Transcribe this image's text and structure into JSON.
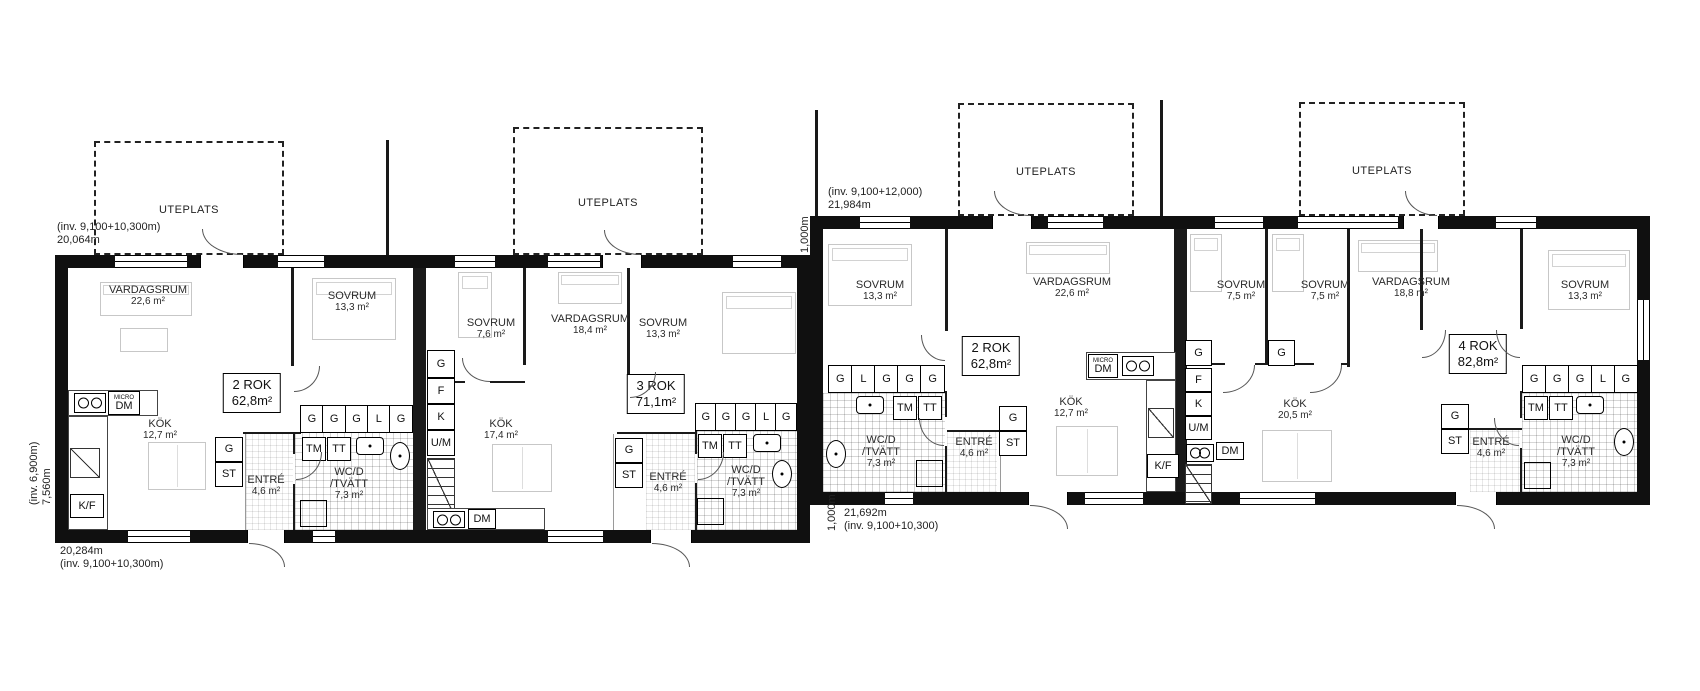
{
  "uteplats_label": "UTEPLATS",
  "cab": {
    "g": "G",
    "st": "ST",
    "l": "L",
    "tm": "TM",
    "tt": "TT",
    "kf": "K/F",
    "dm": "DM",
    "micro": "MICRO",
    "f": "F",
    "k": "K",
    "um": "U/M"
  },
  "dims": {
    "a_top_line1": "(inv. 9,100+10,300m)",
    "a_top_line2": "20,064m",
    "a_bottom_line1": "20,284m",
    "a_bottom_line2": "(inv. 9,100+10,300m)",
    "a_left_line1": "(inv. 6,900m)",
    "a_left_line2": "7,560m",
    "b_top_line1": "(inv. 9,100+12,000)",
    "b_top_line2": "21,984m",
    "b_bottom_line1": "21,692m",
    "b_bottom_line2": "(inv. 9,100+10,300)",
    "offset_top": "1,000m",
    "offset_bottom": "1,000m"
  },
  "apartments": {
    "a1": {
      "type": "2 ROK",
      "size": "62,8m²",
      "vardagsrum": {
        "name": "VARDAGSRUM",
        "area": "22,6 m²"
      },
      "sovrum": {
        "name": "SOVRUM",
        "area": "13,3 m²"
      },
      "kok": {
        "name": "KÖK",
        "area": "12,7 m²"
      },
      "entre": {
        "name": "ENTRÉ",
        "area": "4,6 m²"
      },
      "wc": {
        "line1": "WC/D",
        "line2": "/TVÄTT",
        "area": "7,3 m²"
      }
    },
    "a2": {
      "type": "3 ROK",
      "size": "71,1m²",
      "sovrum1": {
        "name": "SOVRUM",
        "area": "7,6 m²"
      },
      "vardagsrum": {
        "name": "VARDAGSRUM",
        "area": "18,4 m²"
      },
      "sovrum2": {
        "name": "SOVRUM",
        "area": "13,3 m²"
      },
      "kok": {
        "name": "KÖK",
        "area": "17,4 m²"
      },
      "entre": {
        "name": "ENTRÉ",
        "area": "4,6 m²"
      },
      "wc": {
        "line1": "WC/D",
        "line2": "/TVÄTT",
        "area": "7,3 m²"
      }
    },
    "b1": {
      "type": "2 ROK",
      "size": "62,8m²",
      "sovrum": {
        "name": "SOVRUM",
        "area": "13,3 m²"
      },
      "vardagsrum": {
        "name": "VARDAGSRUM",
        "area": "22,6 m²"
      },
      "kok": {
        "name": "KÖK",
        "area": "12,7 m²"
      },
      "entre": {
        "name": "ENTRÉ",
        "area": "4,6 m²"
      },
      "wc": {
        "line1": "WC/D",
        "line2": "/TVÄTT",
        "area": "7,3 m²"
      }
    },
    "b2": {
      "type": "4 ROK",
      "size": "82,8m²",
      "sovrum1": {
        "name": "SOVRUM",
        "area": "7,5 m²"
      },
      "sovrum2": {
        "name": "SOVRUM",
        "area": "7,5 m²"
      },
      "vardagsrum": {
        "name": "VARDAGSRUM",
        "area": "18,8 m²"
      },
      "sovrum3": {
        "name": "SOVRUM",
        "area": "13,3 m²"
      },
      "kok": {
        "name": "KÖK",
        "area": "20,5 m²"
      },
      "entre": {
        "name": "ENTRÉ",
        "area": "4,6 m²"
      },
      "wc": {
        "line1": "WC/D",
        "line2": "/TVÄTT",
        "area": "7,3 m²"
      }
    }
  }
}
